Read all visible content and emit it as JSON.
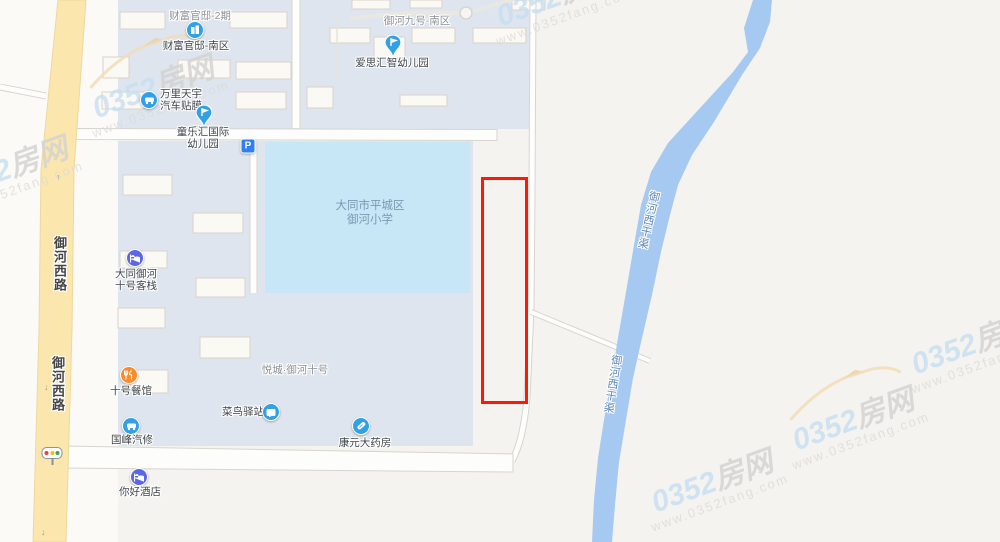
{
  "map_title": "0352房网楼盘地图",
  "colors": {
    "highlight_outline": "#ff1708",
    "river": "#a5c9f1",
    "school_fill": "#c8e7f6",
    "residential_fill": "#dee5ef",
    "yellow_road": "#fbe7ae",
    "poi_blue": "#31a0e5",
    "poi_parking_blue": "#2f7ff0",
    "poi_hotel_indigo": "#5b67e8",
    "poi_restaurant_orange": "#fb8a28",
    "traffic_red": "#e94335",
    "traffic_yellow": "#fbbc04",
    "traffic_green": "#34a853"
  },
  "area_labels": [
    {
      "text": "财富官邸-2期"
    },
    {
      "text": "御河九号-南区"
    },
    {
      "text": "悦城·御河十号"
    }
  ],
  "school": {
    "lines": [
      "大同市平城区",
      "御河小学"
    ]
  },
  "pois": [
    {
      "label": "财富官邸-南区",
      "icon": "building-icon"
    },
    {
      "label": "爱思汇智幼儿园",
      "icon": "pin-icon"
    },
    {
      "lines": [
        "万里天宇",
        "汽车贴膜"
      ],
      "icon": "car-icon"
    },
    {
      "lines": [
        "童乐汇国际",
        "幼儿园"
      ],
      "icon": "pin-icon"
    },
    {
      "label": "P",
      "icon": "parking-icon"
    },
    {
      "lines": [
        "大同御河",
        "十号客栈"
      ],
      "icon": "hotel-icon"
    },
    {
      "label": "十号餐馆",
      "icon": "restaurant-icon"
    },
    {
      "label": "菜鸟驿站",
      "icon": "parcel-box-icon"
    },
    {
      "label": "国峰汽修",
      "icon": "car-icon"
    },
    {
      "label": "康元大药房",
      "icon": "pill-icon"
    },
    {
      "label": "你好酒店",
      "icon": "hotel-icon"
    }
  ],
  "river_labels": [
    {
      "text": "御河西干渠"
    },
    {
      "text": "御河西干渠"
    }
  ],
  "road_labels": [
    {
      "text": "御河西路"
    },
    {
      "text": "御河西路"
    }
  ],
  "arrows": {
    "up": "↑",
    "down": "↓"
  },
  "watermark": {
    "brand_number": "0352",
    "brand_suffix": "房网",
    "url": "www.0352fang.com"
  }
}
